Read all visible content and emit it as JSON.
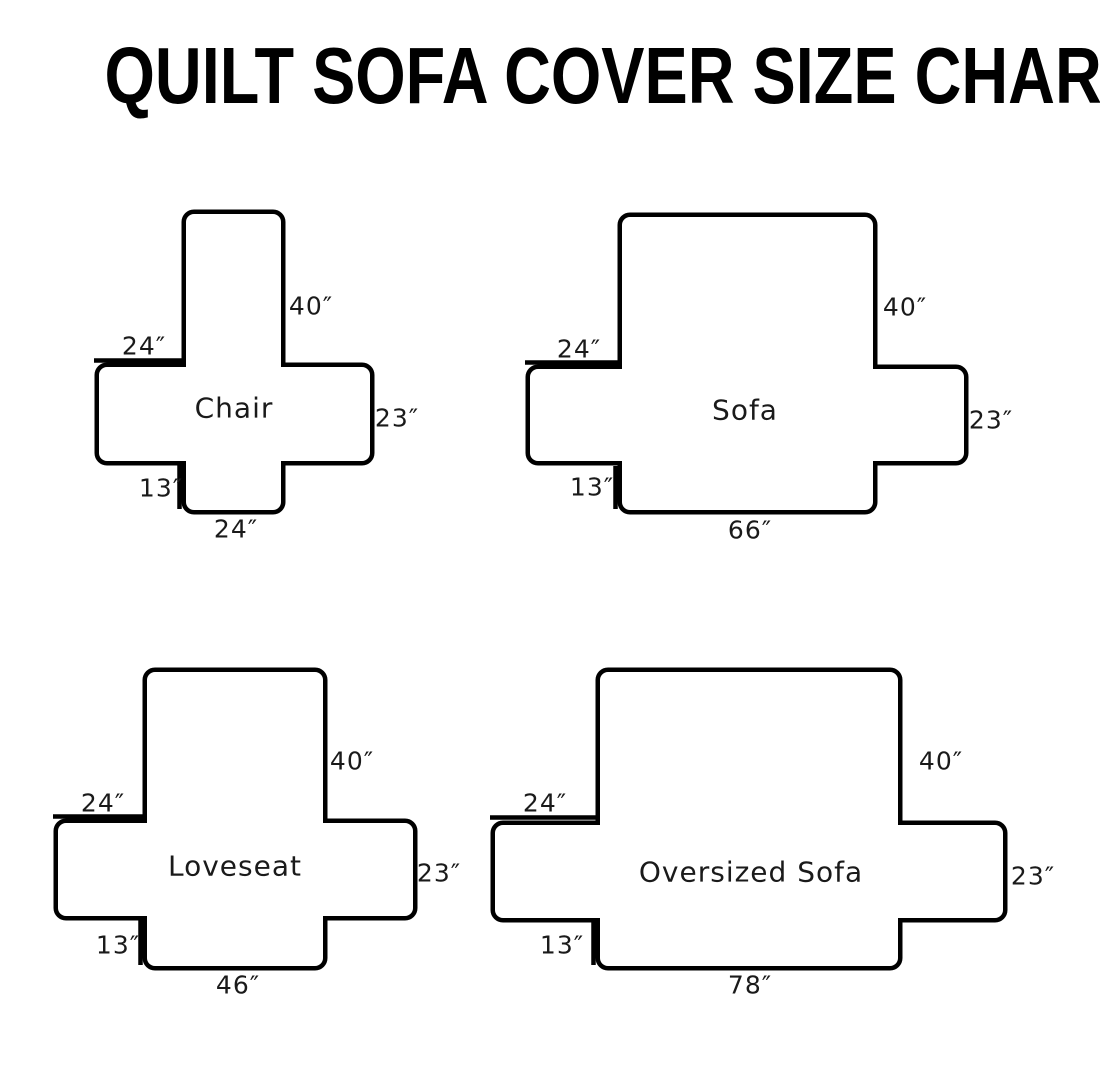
{
  "title": "QUILT SOFA COVER SIZE CHART",
  "diagrams": [
    {
      "name": "Chair",
      "labels": {
        "back_height": "40″",
        "arm_width": "24″",
        "side_depth": "23″",
        "front_drop": "13″",
        "bottom_width": "24″"
      }
    },
    {
      "name": "Sofa",
      "labels": {
        "back_height": "40″",
        "arm_width": "24″",
        "side_depth": "23″",
        "front_drop": "13″",
        "bottom_width": "66″"
      }
    },
    {
      "name": "Loveseat",
      "labels": {
        "back_height": "40″",
        "arm_width": "24″",
        "side_depth": "23″",
        "front_drop": "13″",
        "bottom_width": "46″"
      }
    },
    {
      "name": "Oversized Sofa",
      "labels": {
        "back_height": "40″",
        "arm_width": "24″",
        "side_depth": "23″",
        "front_drop": "13″",
        "bottom_width": "78″"
      }
    }
  ]
}
